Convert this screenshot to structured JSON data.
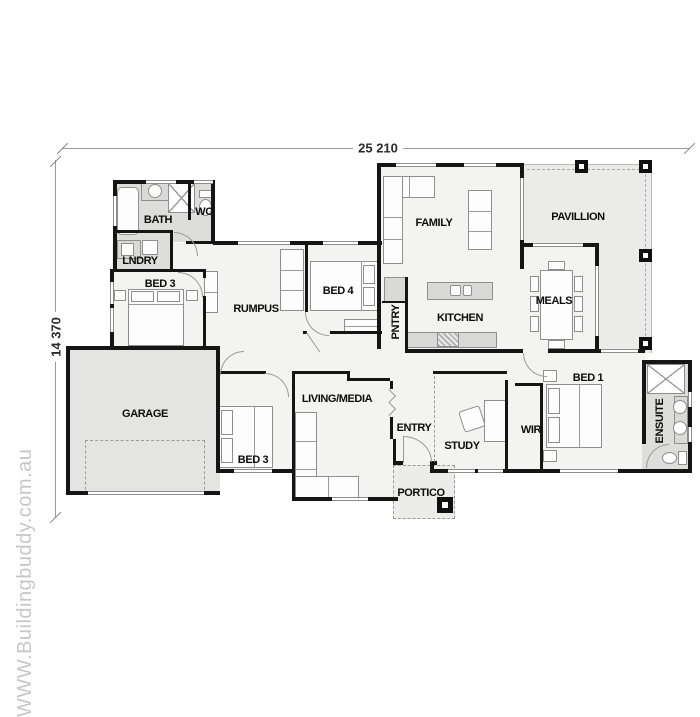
{
  "watermark": "WWW.Buildingbuddy.com.au",
  "dimensions": {
    "width_mm": "25 210",
    "depth_mm": "14 370"
  },
  "rooms": {
    "bath": "BATH",
    "wc": "WC",
    "lndry": "LNDRY",
    "bed3_upper": "BED 3",
    "rumpus": "RUMPUS",
    "bed4": "BED 4",
    "pntry": "PNTRY",
    "kitchen": "KITCHEN",
    "family": "FAMILY",
    "pavillion": "PAVILLION",
    "meals": "MEALS",
    "garage": "GARAGE",
    "bed3_lower": "BED 3",
    "living_media": "LIVING/MEDIA",
    "entry": "ENTRY",
    "study": "STUDY",
    "wir": "WIR",
    "bed1": "BED 1",
    "ensuite": "ENSUITE",
    "portico": "PORTICO"
  },
  "colors": {
    "wall": "#151515",
    "interior_fill": "#f3f3f2",
    "wet_area_fill": "#dddddc",
    "outdoor_fill": "#ebebea",
    "garage_fill": "#e4e4e3",
    "bench_fill": "#d9d9d8",
    "watermark": "#c7c7c7"
  }
}
